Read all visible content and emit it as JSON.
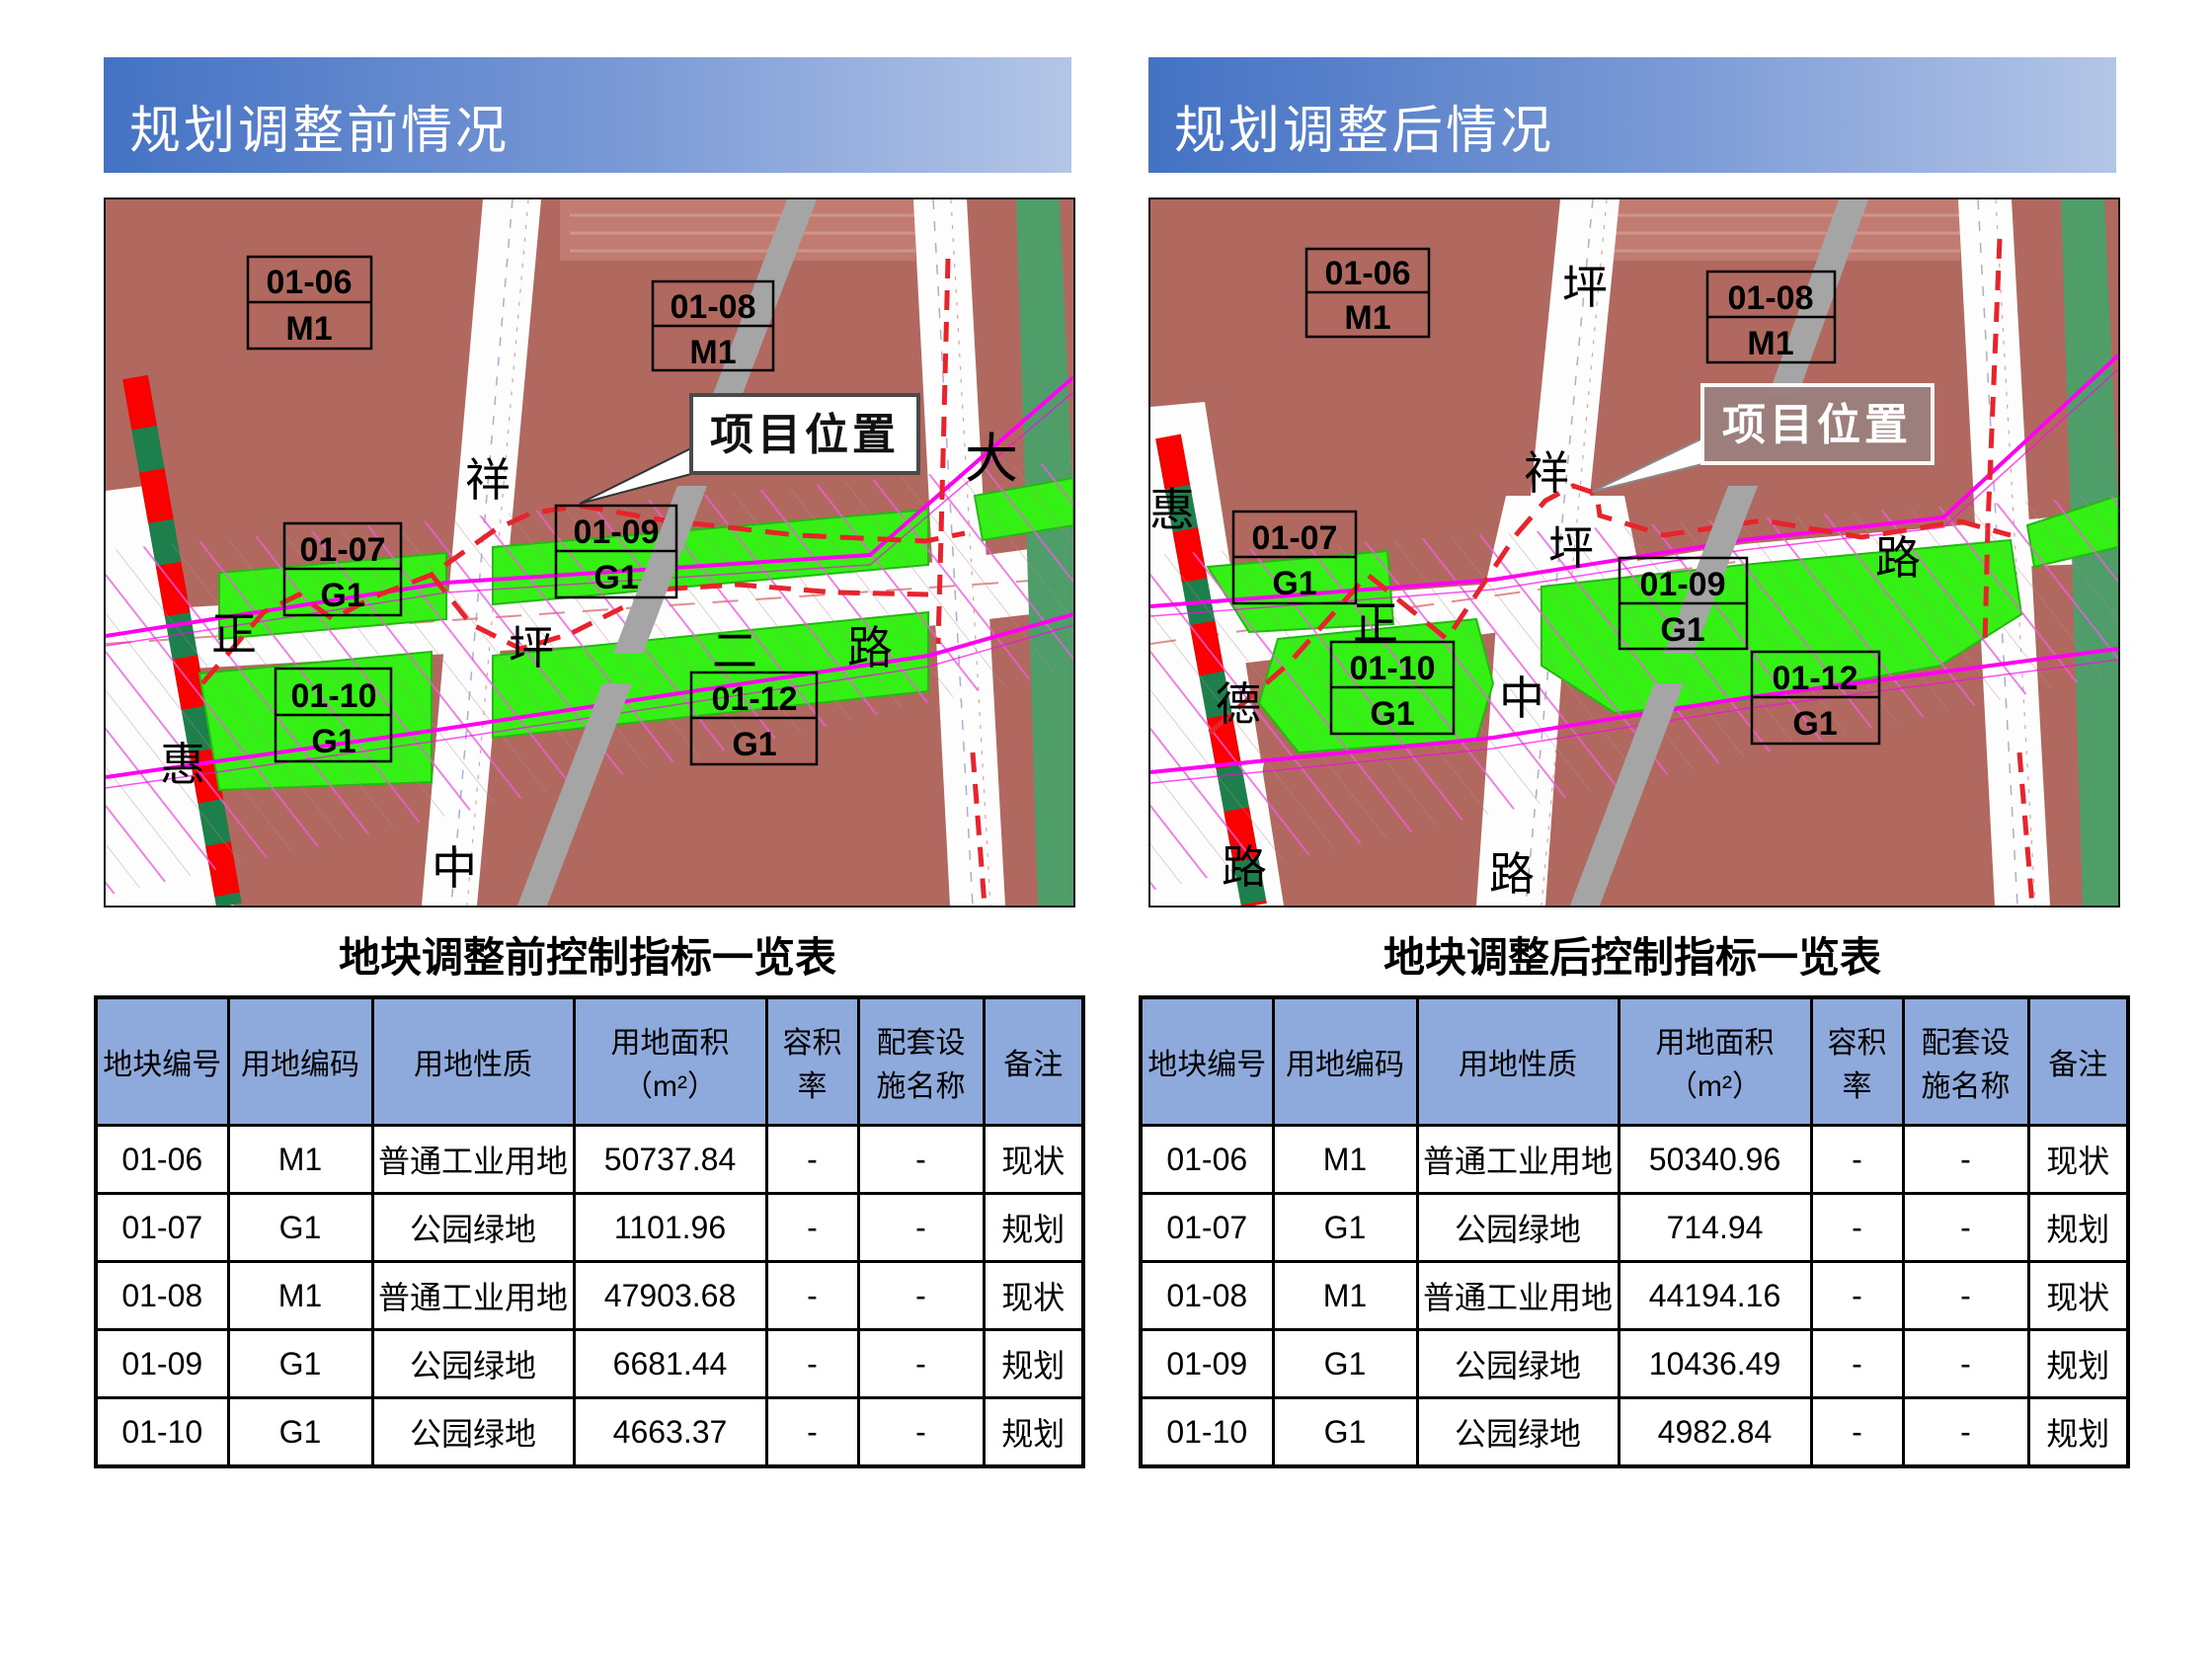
{
  "colors": {
    "banner_gradient_start": "#4472c4",
    "banner_gradient_end": "#b4c6e7",
    "table_header_fill": "#8ea9db",
    "map_land": "#b1695f",
    "map_park_green": "#35f015",
    "map_edge_green": "#4f9d69",
    "map_magenta": "#ff00f0",
    "map_boundary_red": "#e8232b",
    "map_gray_bar": "#a5a5a5"
  },
  "panels": [
    {
      "banner": "规划调整前情况",
      "table_title": "地块调整前控制指标一览表",
      "map": {
        "callout": "项目位置",
        "parcels": [
          {
            "code": "01-06",
            "use": "M1"
          },
          {
            "code": "01-08",
            "use": "M1"
          },
          {
            "code": "01-07",
            "use": "G1"
          },
          {
            "code": "01-09",
            "use": "G1"
          },
          {
            "code": "01-10",
            "use": "G1"
          },
          {
            "code": "01-12",
            "use": "G1"
          }
        ],
        "road_chars": [
          "祥",
          "大",
          "正",
          "坪",
          "二",
          "路",
          "惠",
          "中"
        ]
      },
      "table": {
        "headers": [
          "地块编号",
          "用地编码",
          "用地性质",
          "用地面积\n（m²）",
          "容积率",
          "配套设\n施名称",
          "备注"
        ],
        "rows": [
          [
            "01-06",
            "M1",
            "普通工业用地",
            "50737.84",
            "-",
            "-",
            "现状"
          ],
          [
            "01-07",
            "G1",
            "公园绿地",
            "1101.96",
            "-",
            "-",
            "规划"
          ],
          [
            "01-08",
            "M1",
            "普通工业用地",
            "47903.68",
            "-",
            "-",
            "现状"
          ],
          [
            "01-09",
            "G1",
            "公园绿地",
            "6681.44",
            "-",
            "-",
            "规划"
          ],
          [
            "01-10",
            "G1",
            "公园绿地",
            "4663.37",
            "-",
            "-",
            "规划"
          ]
        ]
      }
    },
    {
      "banner": "规划调整后情况",
      "table_title": "地块调整后控制指标一览表",
      "map": {
        "callout": "项目位置",
        "parcels": [
          {
            "code": "01-06",
            "use": "M1"
          },
          {
            "code": "01-08",
            "use": "M1"
          },
          {
            "code": "01-07",
            "use": "G1"
          },
          {
            "code": "01-09",
            "use": "G1"
          },
          {
            "code": "01-10",
            "use": "G1"
          },
          {
            "code": "01-12",
            "use": "G1"
          }
        ],
        "road_chars": [
          "坪",
          "祥",
          "惠",
          "德",
          "路",
          "正",
          "坪",
          "路",
          "中",
          "路"
        ]
      },
      "table": {
        "headers": [
          "地块编号",
          "用地编码",
          "用地性质",
          "用地面积\n（m²）",
          "容积率",
          "配套设\n施名称",
          "备注"
        ],
        "rows": [
          [
            "01-06",
            "M1",
            "普通工业用地",
            "50340.96",
            "-",
            "-",
            "现状"
          ],
          [
            "01-07",
            "G1",
            "公园绿地",
            "714.94",
            "-",
            "-",
            "规划"
          ],
          [
            "01-08",
            "M1",
            "普通工业用地",
            "44194.16",
            "-",
            "-",
            "现状"
          ],
          [
            "01-09",
            "G1",
            "公园绿地",
            "10436.49",
            "-",
            "-",
            "规划"
          ],
          [
            "01-10",
            "G1",
            "公园绿地",
            "4982.84",
            "-",
            "-",
            "规划"
          ]
        ]
      }
    }
  ]
}
